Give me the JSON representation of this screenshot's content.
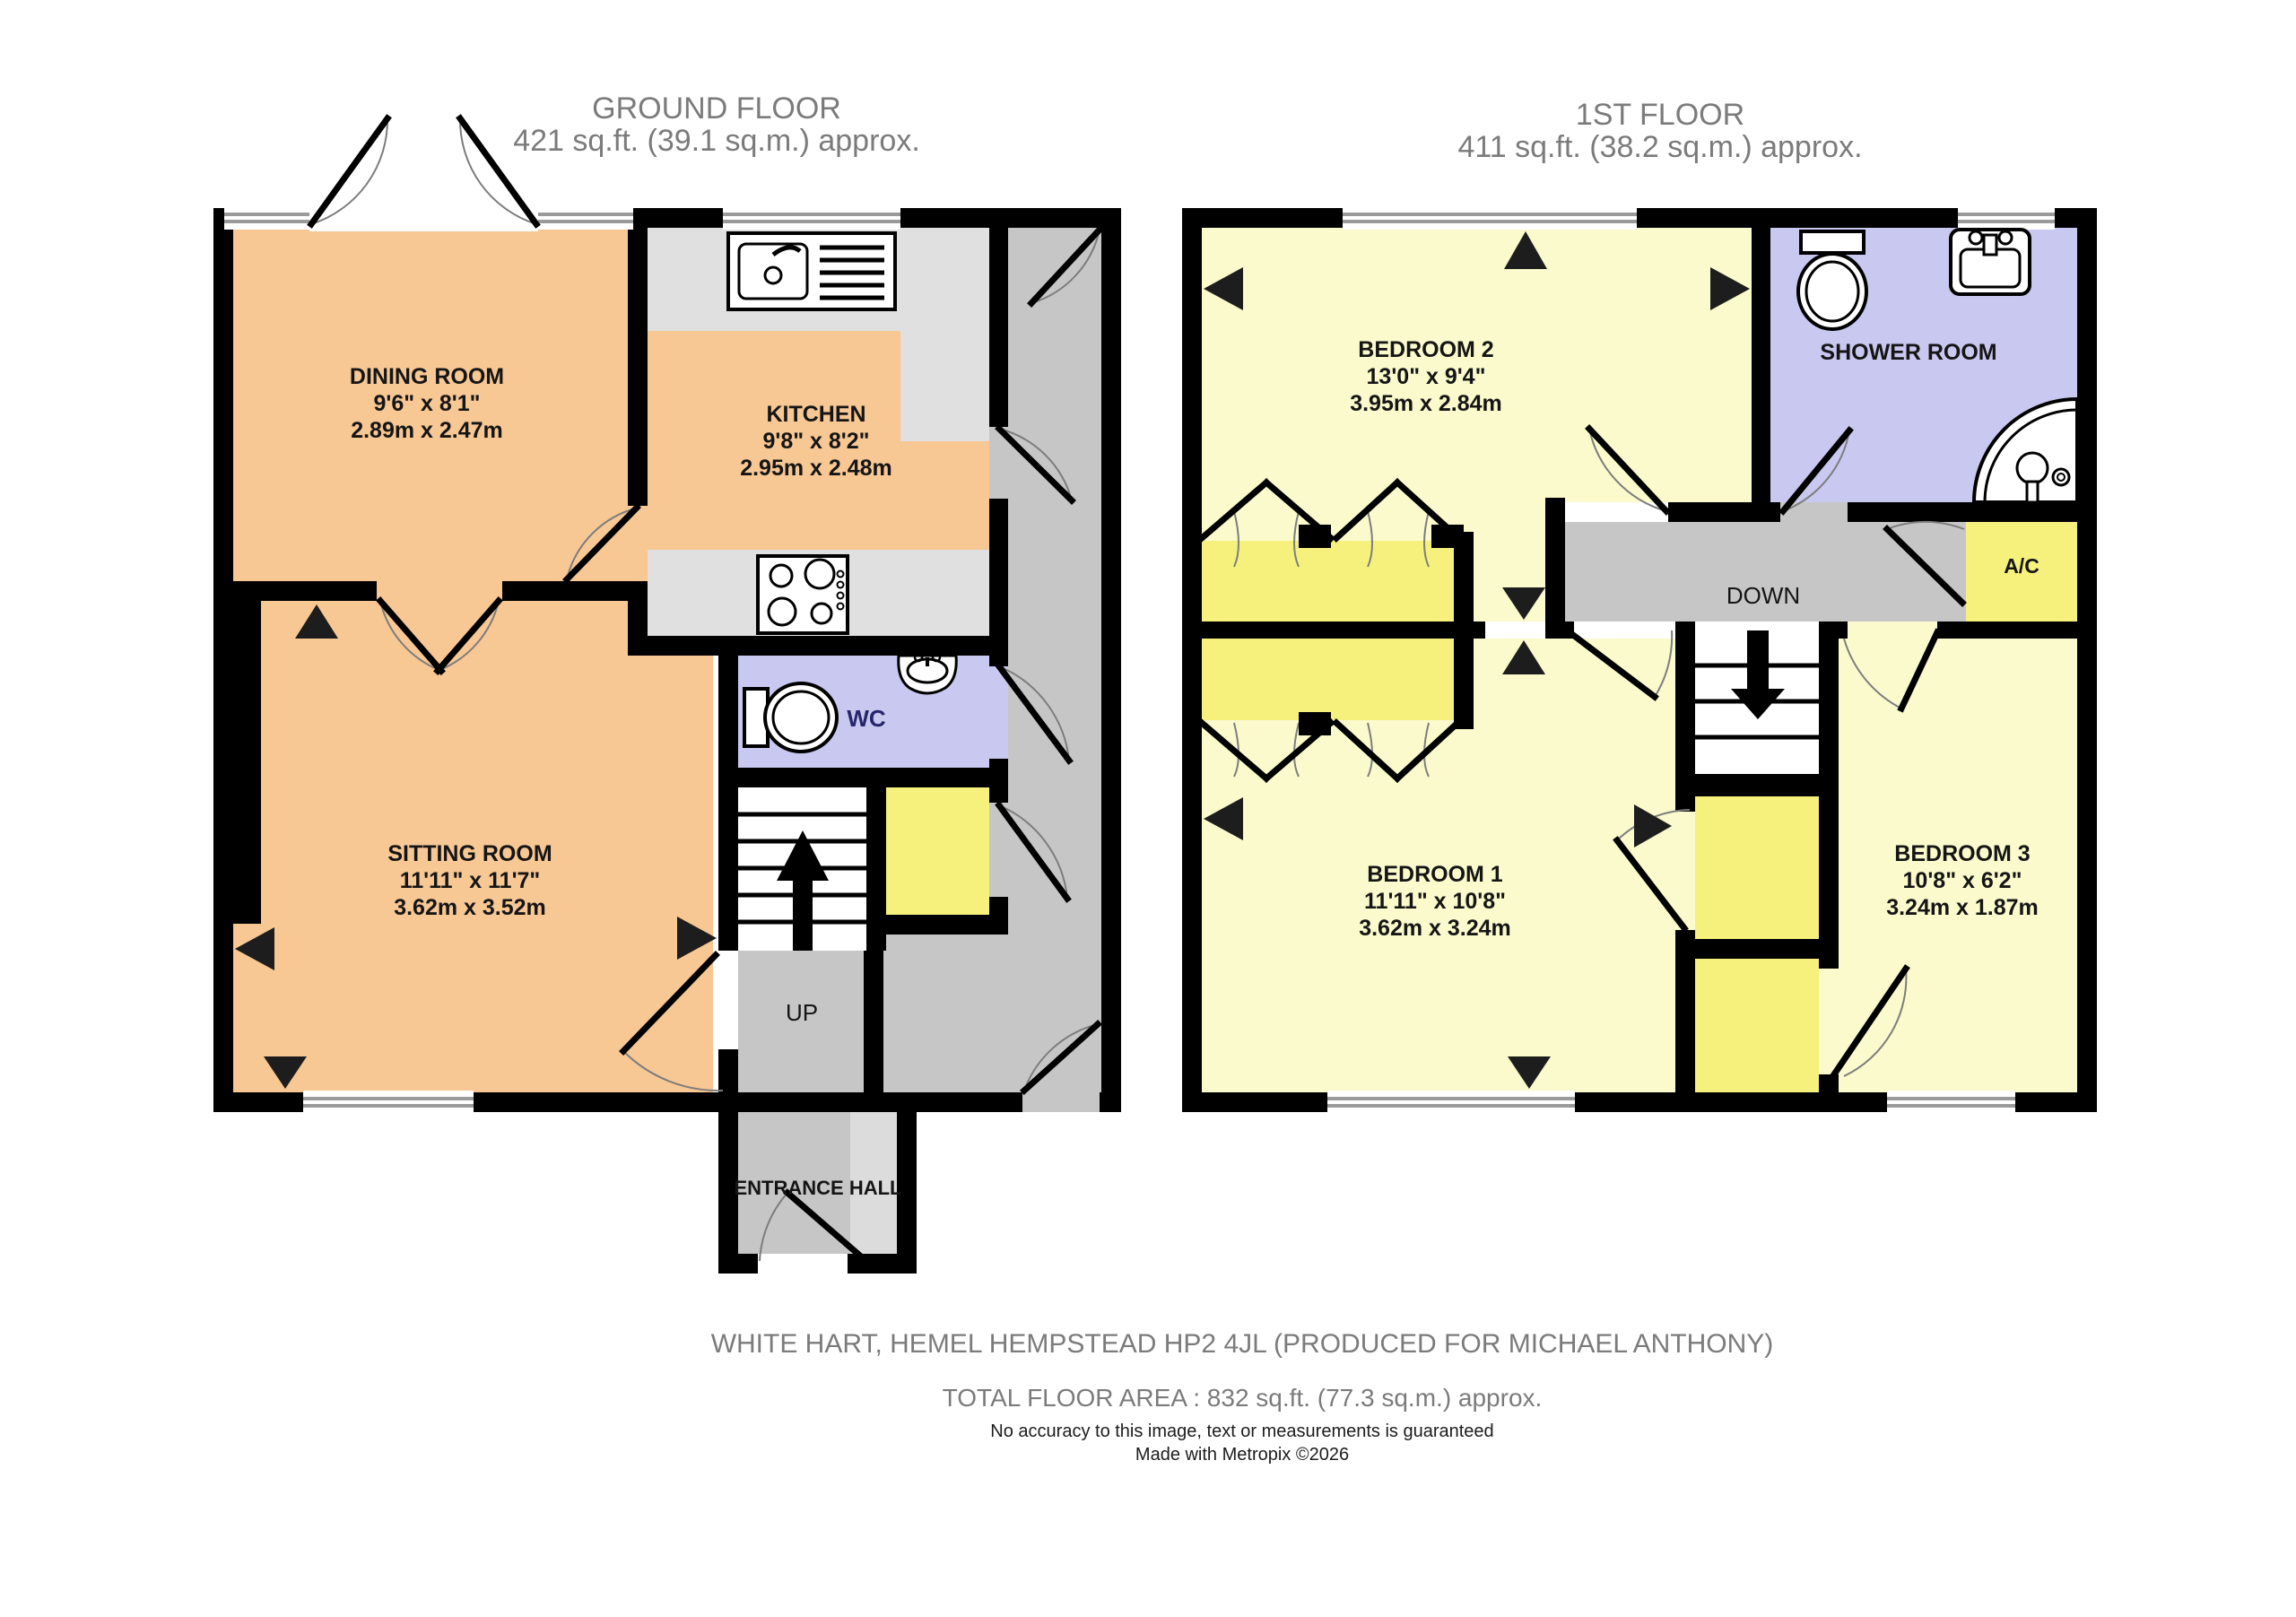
{
  "ground_floor": {
    "title": "GROUND FLOOR",
    "area": "421 sq.ft. (39.1 sq.m.) approx.",
    "dining": {
      "name": "DINING ROOM",
      "imperial": "9'6\"  x 8'1\"",
      "metric": "2.89m  x 2.47m"
    },
    "kitchen": {
      "name": "KITCHEN",
      "imperial": "9'8\"  x 8'2\"",
      "metric": "2.95m  x 2.48m"
    },
    "sitting": {
      "name": "SITTING ROOM",
      "imperial": "11'11\"  x 11'7\"",
      "metric": "3.62m  x 3.52m"
    },
    "wc_label": "WC",
    "up_label": "UP",
    "entrance_label": "ENTRANCE HALL"
  },
  "first_floor": {
    "title": "1ST FLOOR",
    "area": "411 sq.ft. (38.2 sq.m.) approx.",
    "bedroom1": {
      "name": "BEDROOM 1",
      "imperial": "11'11\"  x 10'8\"",
      "metric": "3.62m  x 3.24m"
    },
    "bedroom2": {
      "name": "BEDROOM 2",
      "imperial": "13'0\"  x 9'4\"",
      "metric": "3.95m  x 2.84m"
    },
    "bedroom3": {
      "name": "BEDROOM 3",
      "imperial": "10'8\"  x 6'2\"",
      "metric": "3.24m  x 1.87m"
    },
    "shower_label": "SHOWER ROOM",
    "ac_label": "A/C",
    "down_label": "DOWN"
  },
  "footer": {
    "address": "WHITE HART, HEMEL HEMPSTEAD HP2 4JL (PRODUCED FOR MICHAEL ANTHONY)",
    "total_area": "TOTAL FLOOR AREA : 832 sq.ft. (77.3 sq.m.) approx.",
    "disclaimer": "No accuracy to this image, text or measurements is guaranteed",
    "credit": "Made with Metropix ©2026"
  },
  "colors": {
    "room_peach": "#F7C794",
    "room_pale_yellow": "#FAFACD",
    "cupboard_yellow": "#F6F17D",
    "bathroom_lavender": "#C8C8F0",
    "hall_gray": "#C6C6C6",
    "counter_gray": "#E0E0E0",
    "wall_black": "#000000"
  }
}
